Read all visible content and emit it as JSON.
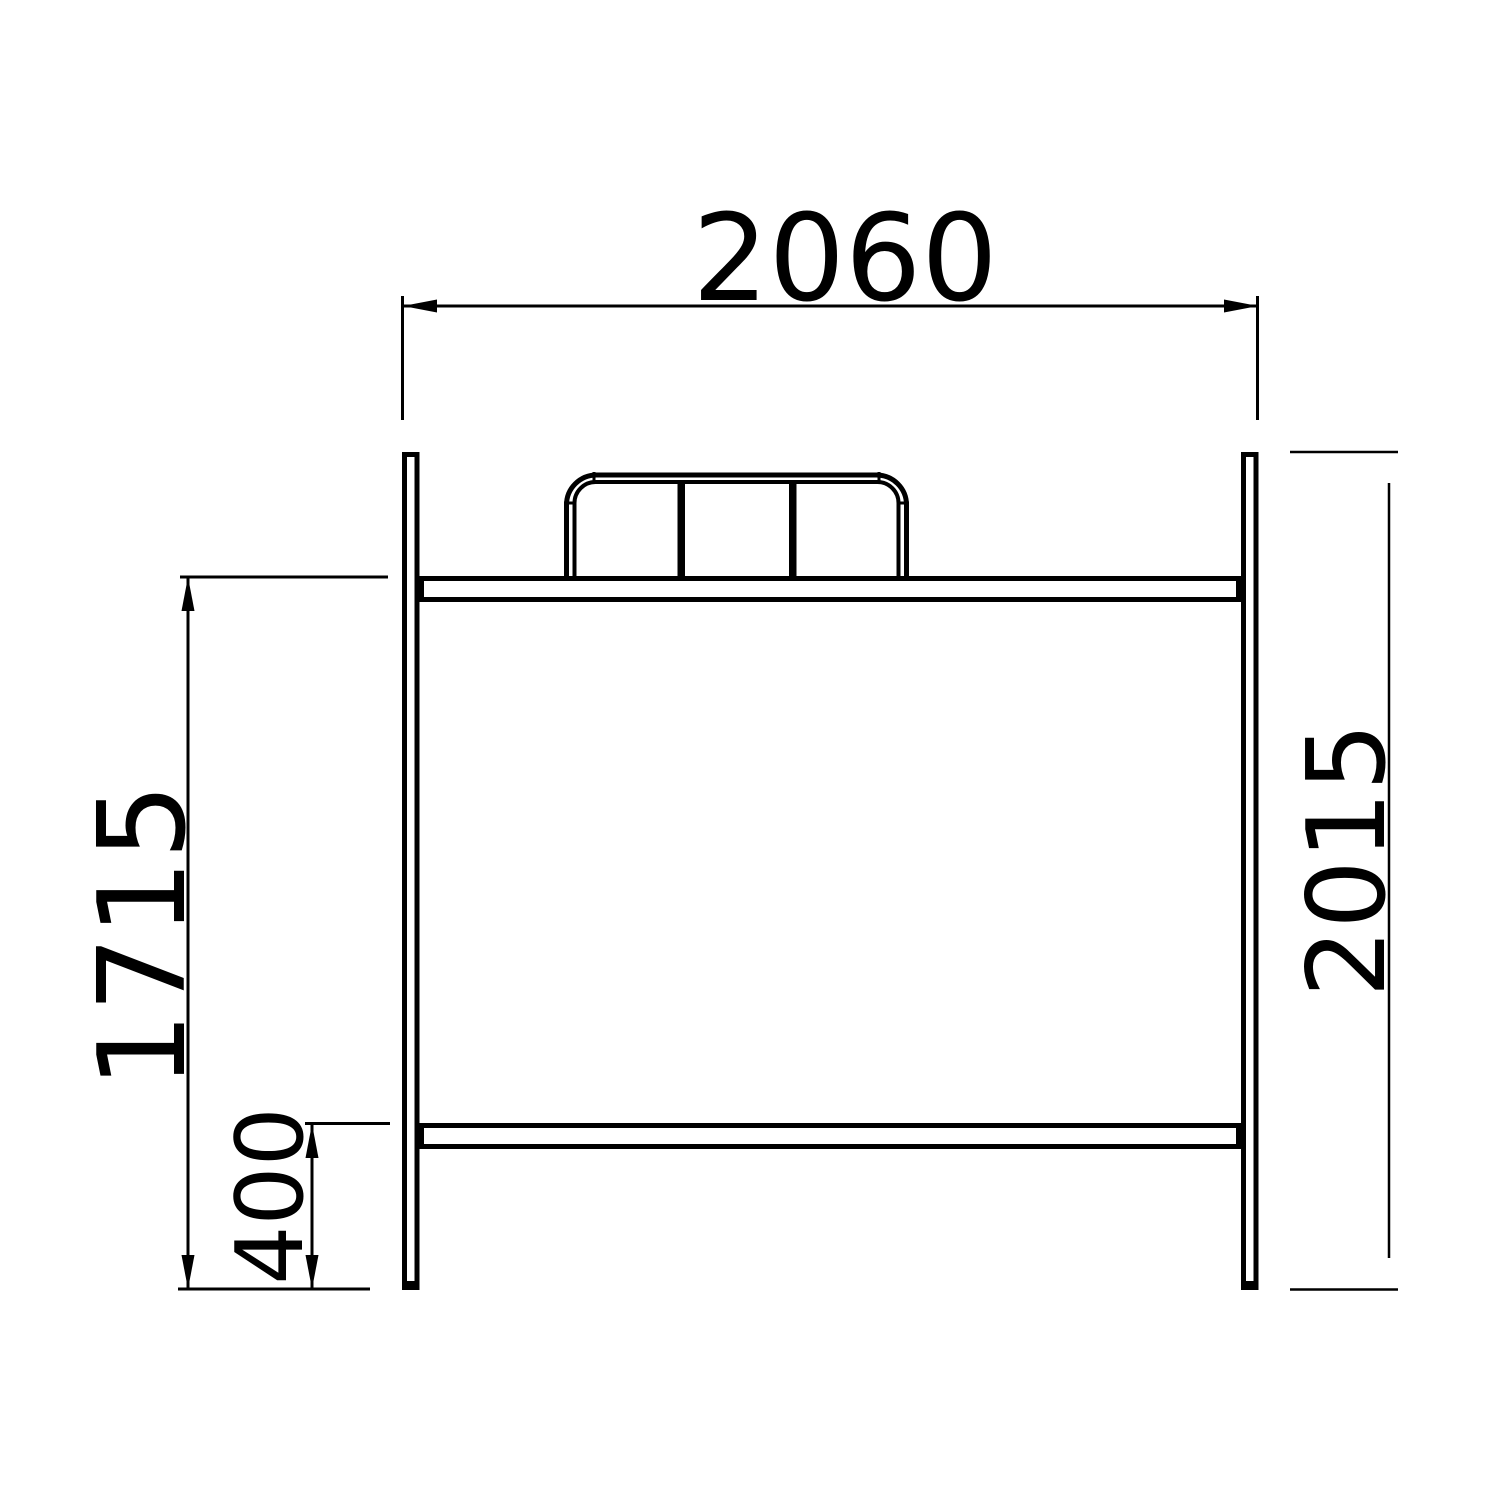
{
  "drawing": {
    "title": "bed-end-frame-elevation",
    "units": "mm",
    "colors": {
      "line": "#000000",
      "background": "#ffffff"
    },
    "dimensions": {
      "overall_width": {
        "label": "2060",
        "orientation": "horizontal",
        "position": "top"
      },
      "overall_height": {
        "label": "2015",
        "orientation": "vertical",
        "position": "right"
      },
      "upper_platform_height": {
        "label": "1715",
        "orientation": "vertical",
        "position": "left"
      },
      "lower_rail_height": {
        "label": "400",
        "orientation": "vertical",
        "position": "bottom-left"
      }
    }
  }
}
